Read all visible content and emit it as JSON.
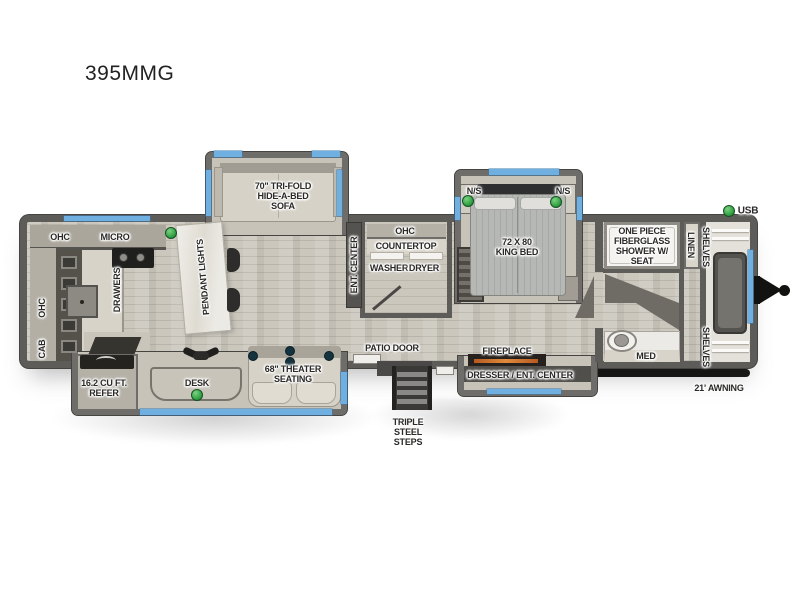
{
  "title": "395MMG",
  "colors": {
    "accent_blue": "#6FB0E0",
    "led_green": "#35A343",
    "wall_gray": "#5D5C59",
    "floor_wood": "#CBC7BD",
    "fixture_black": "#1E1D1B",
    "fireplace_orange": "#D9833B"
  },
  "labels": {
    "kitchen": {
      "ohc_rear": "OHC",
      "micro": "MICRO",
      "ohc_wall": "OHC",
      "cab": "CAB",
      "drawers": "DRAWERS",
      "pendant_lights": "PENDANT LIGHTS",
      "refer": "16.2 CU FT. REFER",
      "desk": "DESK"
    },
    "living": {
      "sofa": "70\" TRI-FOLD HIDE-A-BED SOFA",
      "theater_seating": "68\" THEATER SEATING",
      "ent_center": "ENT. CENTER"
    },
    "laundry": {
      "ohc": "OHC",
      "countertop": "COUNTERTOP",
      "washer": "WASHER",
      "dryer": "DRYER"
    },
    "entry": {
      "patio_door": "PATIO DOOR",
      "steps": "TRIPLE STEEL STEPS"
    },
    "bedroom": {
      "nightstand_left": "N/S",
      "nightstand_right": "N/S",
      "king_bed": "72 X 80 KING BED",
      "fireplace": "FIREPLACE",
      "dresser": "DRESSER / ENT. CENTER"
    },
    "bathroom": {
      "shower": "ONE PIECE FIBERGLASS SHOWER W/ SEAT",
      "med": "MED",
      "linen": "LINEN"
    },
    "front_closet": {
      "shelves_top": "SHELVES",
      "shelves_bottom": "SHELVES"
    },
    "exterior": {
      "usb": "USB",
      "awning": "21' AWNING"
    }
  }
}
